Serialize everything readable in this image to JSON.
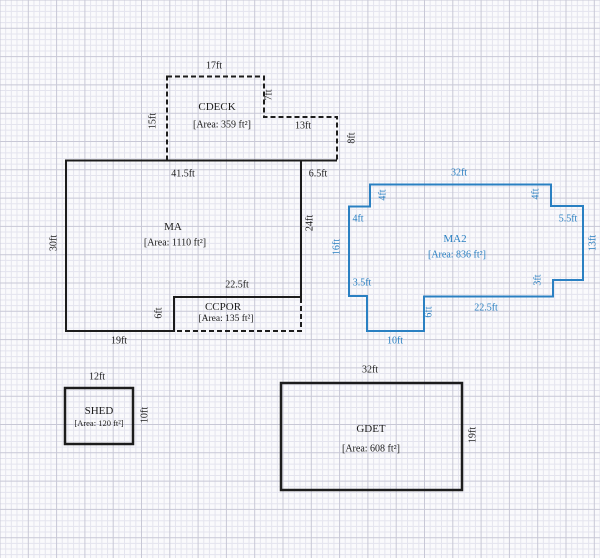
{
  "canvas": {
    "width": 600,
    "height": 558,
    "background": "#fafafc",
    "grid": {
      "minor_px": 5.66,
      "major_every": 5,
      "minor_color": "#e4e4ee",
      "major_color": "#c8c8d6"
    }
  },
  "colors": {
    "ink": "#1c1c1c",
    "highlight_blue": "#2a80c2"
  },
  "shapes": [
    {
      "id": "cdeck",
      "name": "CDECK",
      "area_text": "[Area: 359 ft²]",
      "color": "#1c1c1c",
      "paths": [
        {
          "points": [
            [
              167,
              76.5
            ],
            [
              264,
              76.5
            ],
            [
              264,
              117
            ],
            [
              337,
              117
            ],
            [
              337,
              160.5
            ],
            [
              167,
              160.5
            ]
          ],
          "closed": true,
          "style": "dashed",
          "width": 2
        }
      ],
      "labels": [
        {
          "text": "CDECK",
          "x": 217,
          "y": 107,
          "cls": "name"
        },
        {
          "text": "[Area: 359 ft²]",
          "x": 222,
          "y": 125,
          "cls": "area"
        },
        {
          "text": "17ft",
          "x": 214,
          "y": 66,
          "cls": "dim"
        },
        {
          "text": "15ft",
          "x": 153,
          "y": 121,
          "cls": "dim",
          "rot": true
        },
        {
          "text": "7ft",
          "x": 269,
          "y": 95,
          "cls": "dim",
          "rot": true
        },
        {
          "text": "13ft",
          "x": 303,
          "y": 126,
          "cls": "dim"
        },
        {
          "text": "8ft",
          "x": 352,
          "y": 138,
          "cls": "dim",
          "rot": true
        }
      ]
    },
    {
      "id": "ccpor",
      "name": "CCPOR",
      "area_text": "[Area: 135 ft²]",
      "color": "#1c1c1c",
      "paths": [
        {
          "points": [
            [
              174,
              297
            ],
            [
              301,
              297
            ],
            [
              301,
              331
            ],
            [
              174,
              331
            ]
          ],
          "closed": true,
          "style": "dashed",
          "width": 2
        }
      ],
      "labels": [
        {
          "text": "CCPOR",
          "x": 223,
          "y": 307,
          "cls": "name"
        },
        {
          "text": "[Area: 135 ft²]",
          "x": 226,
          "y": 319,
          "cls": "area",
          "size": 9.5
        },
        {
          "text": "22.5ft",
          "x": 237,
          "y": 285,
          "cls": "dim"
        },
        {
          "text": "6ft",
          "x": 159,
          "y": 313,
          "cls": "dim",
          "rot": true
        }
      ]
    },
    {
      "id": "ma",
      "name": "MA",
      "area_text": "[Area: 1110 ft²]",
      "color": "#1c1c1c",
      "paths": [
        {
          "points": [
            [
              66,
              160.5
            ],
            [
              301,
              160.5
            ],
            [
              301,
              297
            ],
            [
              174,
              297
            ],
            [
              174,
              331
            ],
            [
              66,
              331
            ]
          ],
          "closed": true,
          "style": "solid",
          "width": 2
        },
        {
          "points": [
            [
              301,
              160.5
            ],
            [
              337,
              160.5
            ]
          ],
          "closed": false,
          "style": "dashed",
          "width": 2
        }
      ],
      "labels": [
        {
          "text": "MA",
          "x": 173,
          "y": 227,
          "cls": "name"
        },
        {
          "text": "[Area: 1110 ft²]",
          "x": 175,
          "y": 243,
          "cls": "area"
        },
        {
          "text": "41.5ft",
          "x": 183,
          "y": 174,
          "cls": "dim"
        },
        {
          "text": "6.5ft",
          "x": 318,
          "y": 174,
          "cls": "dim"
        },
        {
          "text": "30ft",
          "x": 54,
          "y": 243,
          "cls": "dim",
          "rot": true
        },
        {
          "text": "24ft",
          "x": 310,
          "y": 223,
          "cls": "dim",
          "rot": true
        },
        {
          "text": "19ft",
          "x": 119,
          "y": 341,
          "cls": "dim"
        }
      ]
    },
    {
      "id": "ma2",
      "name": "MA2",
      "area_text": "[Area: 836 ft²]",
      "color": "#2a80c2",
      "paths": [
        {
          "points": [
            [
              370,
              184.5
            ],
            [
              551,
              184.5
            ],
            [
              551,
              206
            ],
            [
              583,
              206
            ],
            [
              583,
              280
            ],
            [
              553,
              280
            ],
            [
              553,
              296.5
            ],
            [
              424,
              296.5
            ],
            [
              424,
              331
            ],
            [
              367,
              331
            ],
            [
              367,
              296
            ],
            [
              349,
              296
            ],
            [
              349,
              206.5
            ],
            [
              370,
              206.5
            ]
          ],
          "closed": true,
          "style": "solid",
          "width": 2
        }
      ],
      "labels": [
        {
          "text": "MA2",
          "x": 455,
          "y": 239,
          "cls": "name"
        },
        {
          "text": "[Area: 836 ft²]",
          "x": 457,
          "y": 255,
          "cls": "area"
        },
        {
          "text": "32ft",
          "x": 459,
          "y": 173,
          "cls": "dim"
        },
        {
          "text": "4ft",
          "x": 383,
          "y": 195,
          "cls": "dim",
          "rot": true
        },
        {
          "text": "4ft",
          "x": 358,
          "y": 219,
          "cls": "dim"
        },
        {
          "text": "16ft",
          "x": 337,
          "y": 247,
          "cls": "dim",
          "rot": true
        },
        {
          "text": "3.5ft",
          "x": 362,
          "y": 283,
          "cls": "dim"
        },
        {
          "text": "10ft",
          "x": 395,
          "y": 341,
          "cls": "dim"
        },
        {
          "text": "6ft",
          "x": 429,
          "y": 312,
          "cls": "dim",
          "rot": true
        },
        {
          "text": "22.5ft",
          "x": 486,
          "y": 308,
          "cls": "dim"
        },
        {
          "text": "3ft",
          "x": 538,
          "y": 280,
          "cls": "dim",
          "rot": true
        },
        {
          "text": "13ft",
          "x": 593,
          "y": 243,
          "cls": "dim",
          "rot": true
        },
        {
          "text": "5.5ft",
          "x": 568,
          "y": 219,
          "cls": "dim"
        },
        {
          "text": "4ft",
          "x": 536,
          "y": 194,
          "cls": "dim",
          "rot": true
        }
      ]
    },
    {
      "id": "shed",
      "name": "SHED",
      "area_text": "[Area: 120 ft²]",
      "color": "#1c1c1c",
      "paths": [
        {
          "points": [
            [
              65,
              388
            ],
            [
              133,
              388
            ],
            [
              133,
              444
            ],
            [
              65,
              444
            ]
          ],
          "closed": true,
          "style": "solid",
          "width": 2.5
        }
      ],
      "labels": [
        {
          "text": "SHED",
          "x": 99,
          "y": 411,
          "cls": "name"
        },
        {
          "text": "[Area: 120 ft²]",
          "x": 99,
          "y": 423,
          "cls": "area",
          "size": 8.5
        },
        {
          "text": "12ft",
          "x": 97,
          "y": 377,
          "cls": "dim"
        },
        {
          "text": "10ft",
          "x": 145,
          "y": 415,
          "cls": "dim",
          "rot": true
        }
      ]
    },
    {
      "id": "gdet",
      "name": "GDET",
      "area_text": "[Area: 608 ft²]",
      "color": "#1c1c1c",
      "paths": [
        {
          "points": [
            [
              281,
              383
            ],
            [
              462,
              383
            ],
            [
              462,
              490
            ],
            [
              281,
              490
            ]
          ],
          "closed": true,
          "style": "solid",
          "width": 2.5
        }
      ],
      "labels": [
        {
          "text": "GDET",
          "x": 371,
          "y": 429,
          "cls": "name"
        },
        {
          "text": "[Area: 608 ft²]",
          "x": 371,
          "y": 449,
          "cls": "area"
        },
        {
          "text": "32ft",
          "x": 370,
          "y": 370,
          "cls": "dim"
        },
        {
          "text": "19ft",
          "x": 473,
          "y": 435,
          "cls": "dim",
          "rot": true
        }
      ]
    }
  ]
}
